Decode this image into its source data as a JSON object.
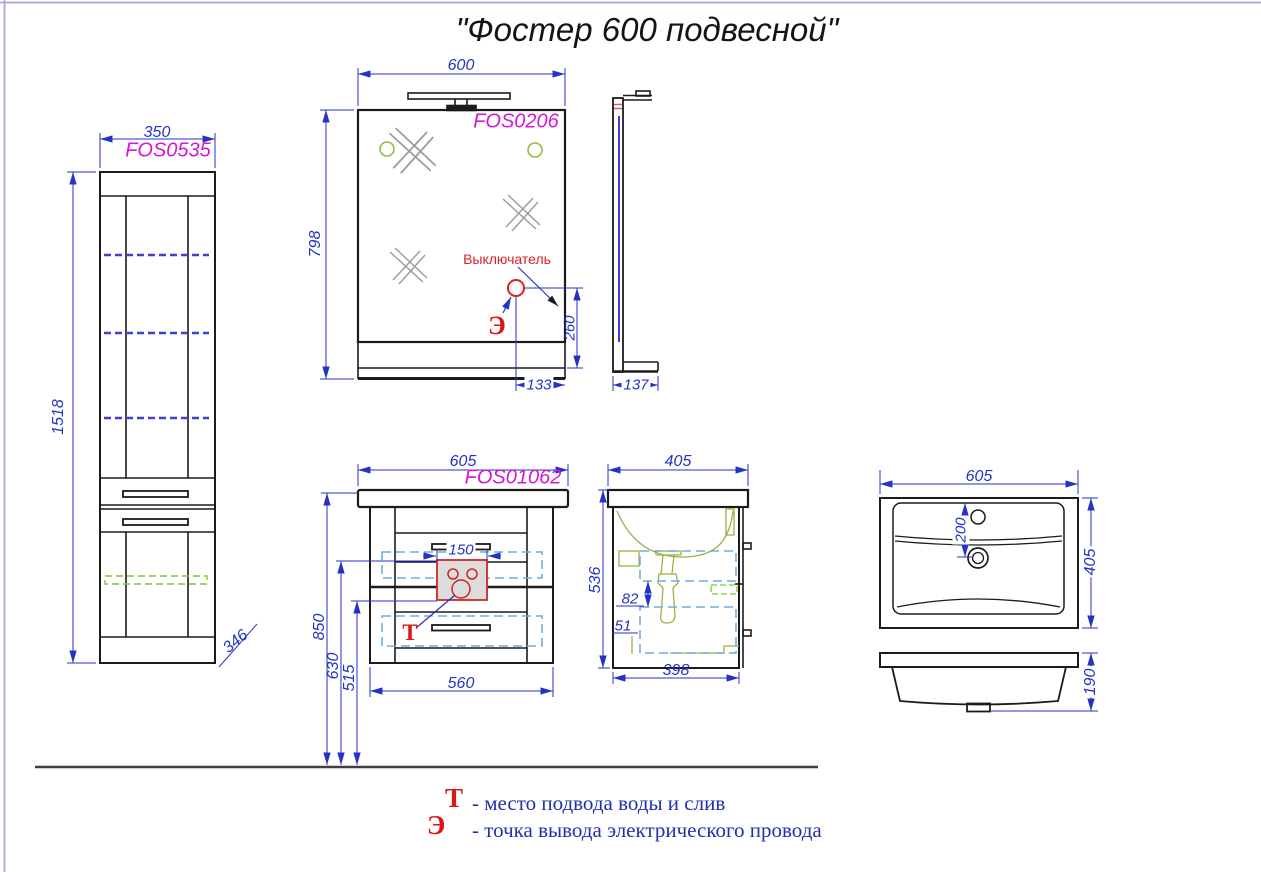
{
  "title": "\"Фостер 600 подвесной\"",
  "views": {
    "cabinet": {
      "model": "FOS0535",
      "width": "350",
      "height": "1518",
      "depth": "346"
    },
    "mirror": {
      "model": "FOS0206",
      "width": "600",
      "height": "798",
      "switch_height": "260",
      "switch_offset": "133",
      "switch_label": "Выключатель",
      "electric_symbol": "Э"
    },
    "mirror_side": {
      "depth": "137"
    },
    "vanity": {
      "model": "FOS01062",
      "width": "605",
      "body_width": "560",
      "height": "850",
      "inlet_top": "630",
      "inlet_bottom": "515",
      "inlet_width": "150",
      "water_symbol": "Т"
    },
    "vanity_side": {
      "depth": "405",
      "height": "536",
      "dim_a": "82",
      "dim_b": "51",
      "bottom_depth": "398"
    },
    "sink_top": {
      "width": "605",
      "depth": "405",
      "drain_offset": "200"
    },
    "sink_front": {
      "height": "190"
    }
  },
  "legend": {
    "water": {
      "symbol": "Т",
      "text": "- место подвода воды и слив"
    },
    "electric": {
      "symbol": "Э",
      "text": "- точка вывода электрического провода"
    }
  },
  "colors": {
    "dimension": "#2433c4",
    "model_label": "#d318d3",
    "annotation": "#dc2020",
    "legend_text": "#2030b0",
    "mirror_glass": "#4040cc",
    "fitting_green": "#9cb145"
  }
}
